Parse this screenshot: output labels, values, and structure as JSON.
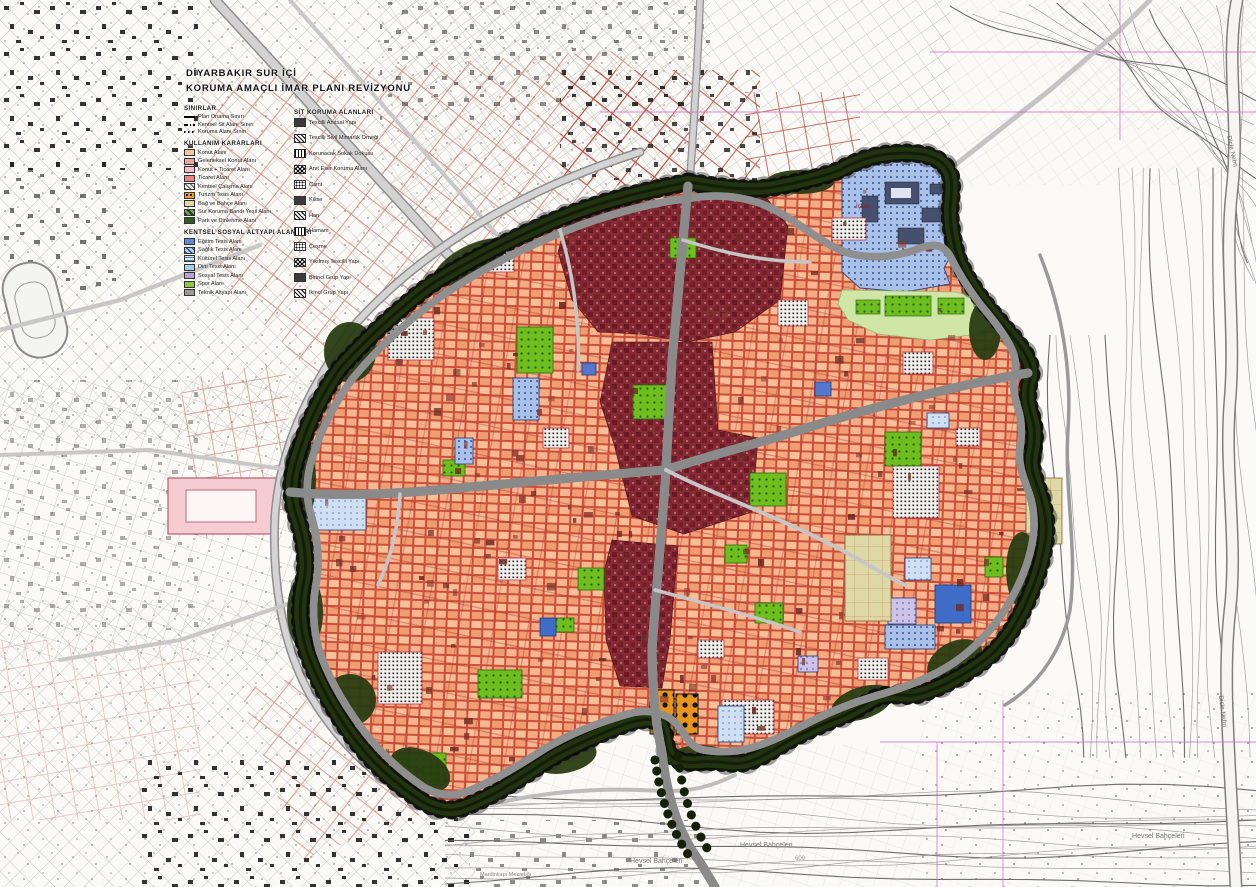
{
  "title": {
    "line1": "DİYARBAKIR SUR İÇİ",
    "line2": "KORUMA AMAÇLI İMAR PLANI REVİZYONU"
  },
  "legend": {
    "sections": [
      {
        "header": "SINIRLAR",
        "items": [
          {
            "label": "Plan Onama Sınırı",
            "swatch": "line-solid"
          },
          {
            "label": "Kentsel Sit Alanı Sınırı",
            "swatch": "line-dashdot"
          },
          {
            "label": "Koruma Alanı Sınırı",
            "swatch": "line-dotted"
          }
        ]
      },
      {
        "header": "KULLANIM KARARLARI",
        "items": [
          {
            "label": "Konut Alanı",
            "swatch": "#f2c9a2"
          },
          {
            "label": "Geleneksel Konut Alanı",
            "swatch": "#f0a59b"
          },
          {
            "label": "Konut + Ticaret Alanı",
            "swatch": "#f5bcc8"
          },
          {
            "label": "Ticaret Alanı",
            "swatch": "#ee8585"
          },
          {
            "label": "Kentsel Çalışma Alanı",
            "swatch": "hatch-gray"
          },
          {
            "label": "Turizm Tesis Alanı",
            "swatch": "dots-orange"
          },
          {
            "label": "Bağ ve Bahçe Alanı",
            "swatch": "#dcd9a8"
          },
          {
            "label": "Sur Koruma Bandı Yeşil Alanı",
            "swatch": "hatch-green"
          },
          {
            "label": "Park ve Dinlenme Alanı",
            "swatch": "#2e5c1e"
          }
        ]
      },
      {
        "header": "KENTSEL SOSYAL ALTYAPI ALANLARI",
        "items": [
          {
            "label": "Eğitim Tesis Alanı",
            "swatch": "#5b8bd8"
          },
          {
            "label": "Sağlık Tesis Alanı",
            "swatch": "hatch-blue"
          },
          {
            "label": "Kültürel Tesis Alanı",
            "swatch": "lines-blue"
          },
          {
            "label": "Dini Tesis Alanı",
            "swatch": "#9fd2e8"
          },
          {
            "label": "Sosyal Tesis Alanı",
            "swatch": "#b9a2d8"
          },
          {
            "label": "Spor Alanı",
            "swatch": "#8cc63e"
          },
          {
            "label": "Teknik Altyapı Alanı",
            "swatch": "#9a9a9a"
          }
        ]
      },
      {
        "header": "SİT KORUMA ALANLARI",
        "items": [
          {
            "label": "Tescilli Anıtsal Yapı",
            "swatch": "bw-solid"
          },
          {
            "label": "Tescilli Sivil Mimarlık Örneği",
            "swatch": "bw-hatch"
          },
          {
            "label": "Korunacak Sokak Dokusu",
            "swatch": "bw-lines"
          },
          {
            "label": "Anıt Eser Koruma Alanı",
            "swatch": "bw-cross"
          },
          {
            "label": "Cami",
            "swatch": "bw-dot"
          },
          {
            "label": "Kilise",
            "swatch": "bw-solid"
          },
          {
            "label": "Han",
            "swatch": "bw-hatch"
          },
          {
            "label": "Hamam",
            "swatch": "bw-lines"
          },
          {
            "label": "Çeşme",
            "swatch": "bw-dot"
          },
          {
            "label": "Yıkılmış Tescilli Yapı",
            "swatch": "bw-cross"
          },
          {
            "label": "Birinci Grup Yapı",
            "swatch": "bw-solid"
          },
          {
            "label": "İkinci Grup Yapı",
            "swatch": "bw-hatch"
          }
        ]
      }
    ]
  },
  "map_labels": [
    {
      "text": "İçkale"
    },
    {
      "text": "Hevsel Bahçeleri"
    },
    {
      "text": "Hevsel Bahçeleri"
    },
    {
      "text": "Hevsel Bahçeleri"
    },
    {
      "text": "Dicle Nehri"
    },
    {
      "text": "Dicle Nehri"
    },
    {
      "text": "Mardinkapı Mezarlığı"
    },
    {
      "text": "600"
    }
  ],
  "colors": {
    "old_city_fill": "#f19a76",
    "parcel_line": "#c23b2a",
    "bazaar_maroon": "#872a33",
    "wall_band": "#1f2b0d",
    "park_green": "#6fbe1f",
    "citadel_blue": "#a9c0e8",
    "reference_magenta": "#d967c8",
    "road_gray": "#cdcdcd"
  }
}
